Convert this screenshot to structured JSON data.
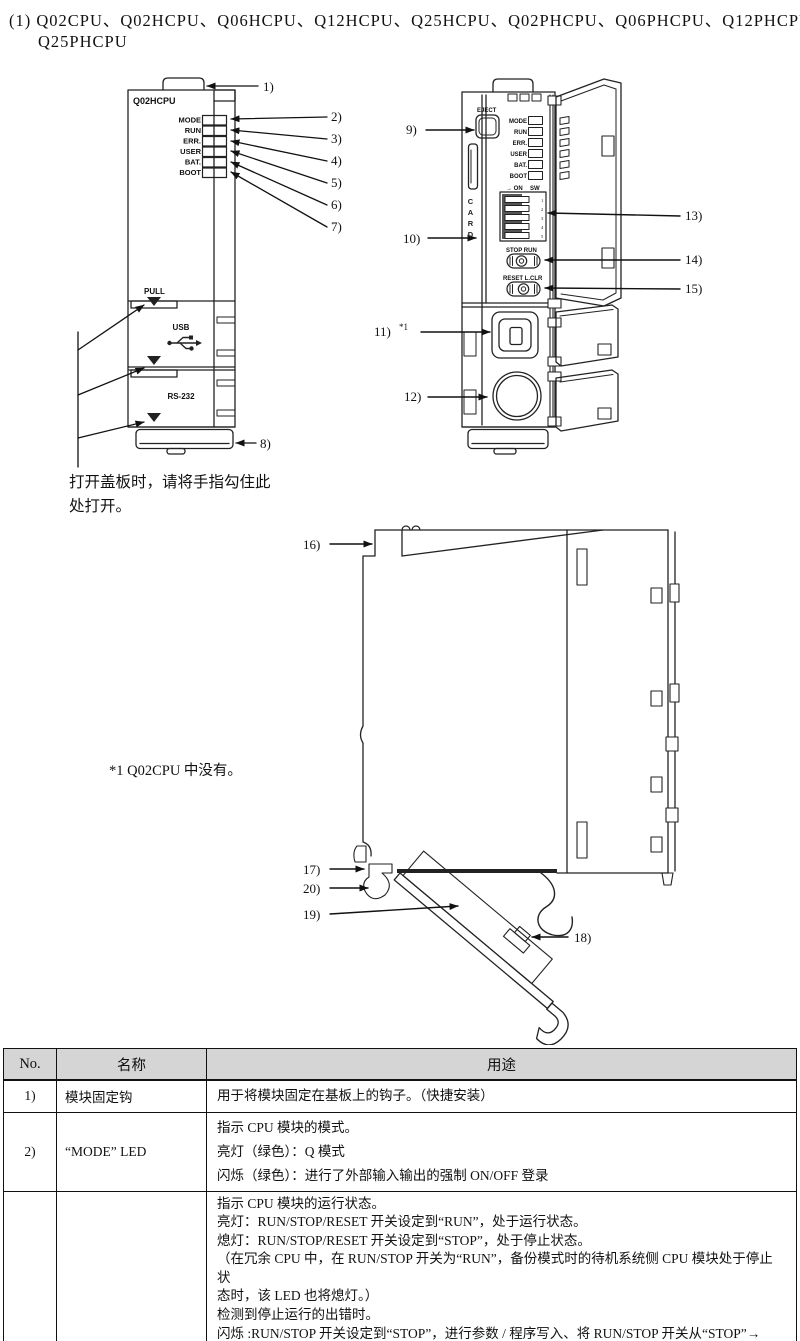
{
  "title": {
    "line1": "(1) Q02CPU、Q02HCPU、Q06HCPU、Q12HCPU、Q25HCPU、Q02PHCPU、Q06PHCPU、Q12PHCPU",
    "line2": "Q25PHCPU"
  },
  "front_view": {
    "model_label": "Q02HCPU",
    "leds": [
      "MODE",
      "RUN",
      "ERR.",
      "USER",
      "BAT.",
      "BOOT"
    ],
    "pull_label": "PULL",
    "usb_label": "USB",
    "rs232_label": "RS-232",
    "callouts": [
      "1)",
      "2)",
      "3)",
      "4)",
      "5)",
      "6)",
      "7)",
      "8)"
    ],
    "cover_note_line1": "打开盖板时，请将手指勾住此",
    "cover_note_line2": "处打开。"
  },
  "open_view": {
    "eject_label": "EJECT",
    "card_label": "CARD",
    "leds": [
      "MODE",
      "RUN",
      "ERR.",
      "USER",
      "BAT.",
      "BOOT"
    ],
    "dip_on_label": "→ ON",
    "dip_sw_label": "SW",
    "dip_numbers": [
      "1",
      "2",
      "3",
      "4",
      "5"
    ],
    "stop_run_label": "STOP RUN",
    "reset_label": "RESET L.CLR",
    "callouts": [
      "9)",
      "10)",
      "11)",
      "12)",
      "13)",
      "14)",
      "15)"
    ],
    "footnote_mark": "*1"
  },
  "side_view": {
    "callouts": [
      "16)",
      "17)",
      "18)",
      "19)",
      "20)"
    ]
  },
  "footnote": "*1 Q02CPU 中没有。",
  "table": {
    "headers": [
      "No.",
      "名称",
      "用途"
    ],
    "rows": [
      {
        "no": "1)",
        "name": "模块固定钩",
        "usage": [
          "用于将模块固定在基板上的钩子。（快捷安装）"
        ]
      },
      {
        "no": "2)",
        "name": "“MODE” LED",
        "usage": [
          "指示 CPU 模块的模式。",
          "亮灯（绿色）：Q 模式",
          "闪烁（绿色）：进行了外部输入输出的强制 ON/OFF 登录"
        ]
      },
      {
        "no": "",
        "name": "",
        "usage": [
          "指示 CPU 模块的运行状态。",
          "亮灯：RUN/STOP/RESET 开关设定到“RUN”，处于运行状态。",
          "熄灯：RUN/STOP/RESET 开关设定到“STOP”，处于停止状态。",
          "（在冗余 CPU 中，在 RUN/STOP 开关为“RUN”，备份模式时的待机系统侧 CPU 模块处于停止状",
          "态时，该 LED 也将熄灯。）",
          "检测到停止运行的出错时。",
          "闪烁 :RUN/STOP 开关设定到“STOP”，进行参数 / 程序写入、将 RUN/STOP 开关从“STOP”→",
          "“RUN”时。"
        ]
      }
    ]
  }
}
